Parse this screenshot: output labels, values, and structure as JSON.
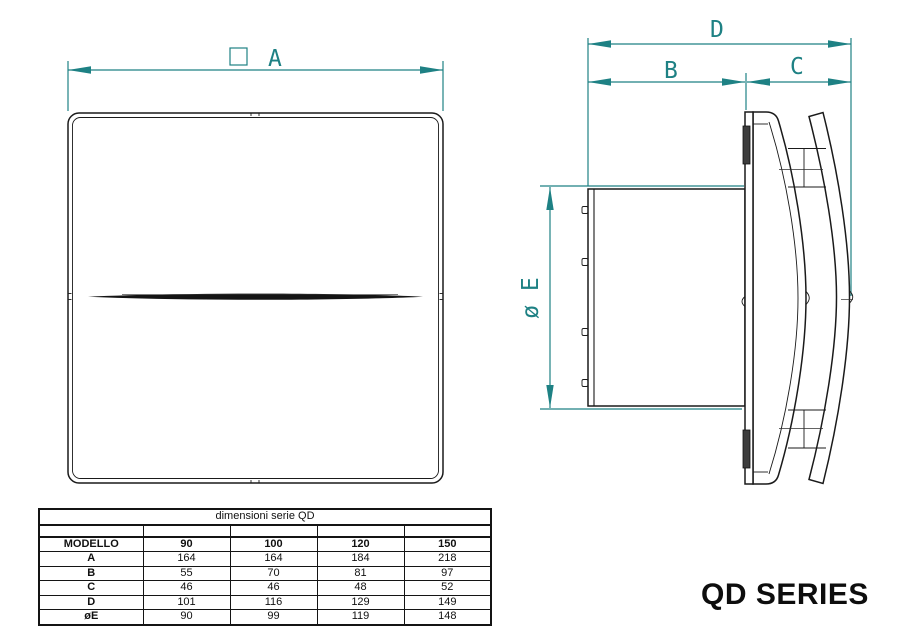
{
  "series_title": "QD SERIES",
  "drawing": {
    "front_view": {
      "dim_a": "A",
      "square_symbol_meaning": "square (equal sides)"
    },
    "side_view": {
      "dim_b": "B",
      "dim_c": "C",
      "dim_d": "D",
      "dim_e": "ø E"
    }
  },
  "table": {
    "title": "dimensioni serie QD",
    "model_header": "MODELLO",
    "models": [
      "90",
      "100",
      "120",
      "150"
    ],
    "rows": [
      {
        "label": "A",
        "values": [
          "164",
          "164",
          "184",
          "218"
        ]
      },
      {
        "label": "B",
        "values": [
          "55",
          "70",
          "81",
          "97"
        ]
      },
      {
        "label": "C",
        "values": [
          "46",
          "46",
          "48",
          "52"
        ]
      },
      {
        "label": "D",
        "values": [
          "101",
          "116",
          "129",
          "149"
        ]
      },
      {
        "label": "øE",
        "values": [
          "90",
          "99",
          "119",
          "148"
        ]
      }
    ]
  },
  "colors": {
    "dimension_lines": "#1e8184",
    "drawing_lines": "#1a1a1a",
    "background": "#ffffff"
  }
}
